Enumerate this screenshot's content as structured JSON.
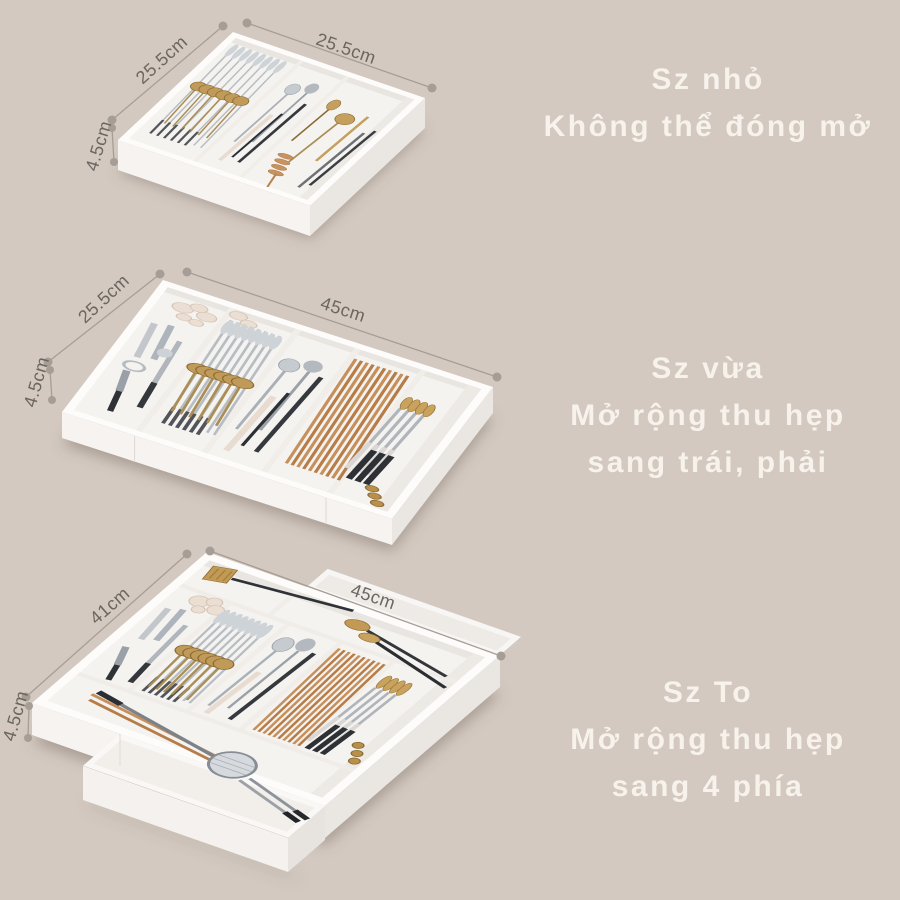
{
  "background_color": "#d3c9c0",
  "colors": {
    "caption_text": "#f7f2ec",
    "dimension_text": "#6b6661",
    "dimension_line": "#a69e96",
    "tray_white": "#fdfcfb",
    "gold_accent": "#c29a55",
    "wood_accent": "#c6905c"
  },
  "sections": [
    {
      "id": "small",
      "caption": [
        "Sz nhỏ",
        "Không thể đóng mở"
      ],
      "dim_depth": "25.5cm",
      "dim_width": "25.5cm",
      "dim_height": "4.5cm"
    },
    {
      "id": "medium",
      "caption": [
        "Sz vừa",
        "Mở rộng thu hẹp",
        "sang trái, phải"
      ],
      "dim_depth": "25.5cm",
      "dim_width": "45cm",
      "dim_height": "4.5cm"
    },
    {
      "id": "large",
      "caption": [
        "Sz To",
        "Mở rộng thu hẹp",
        "sang 4 phía"
      ],
      "dim_depth": "41cm",
      "dim_width": "45cm",
      "dim_height": "4.5cm"
    }
  ]
}
